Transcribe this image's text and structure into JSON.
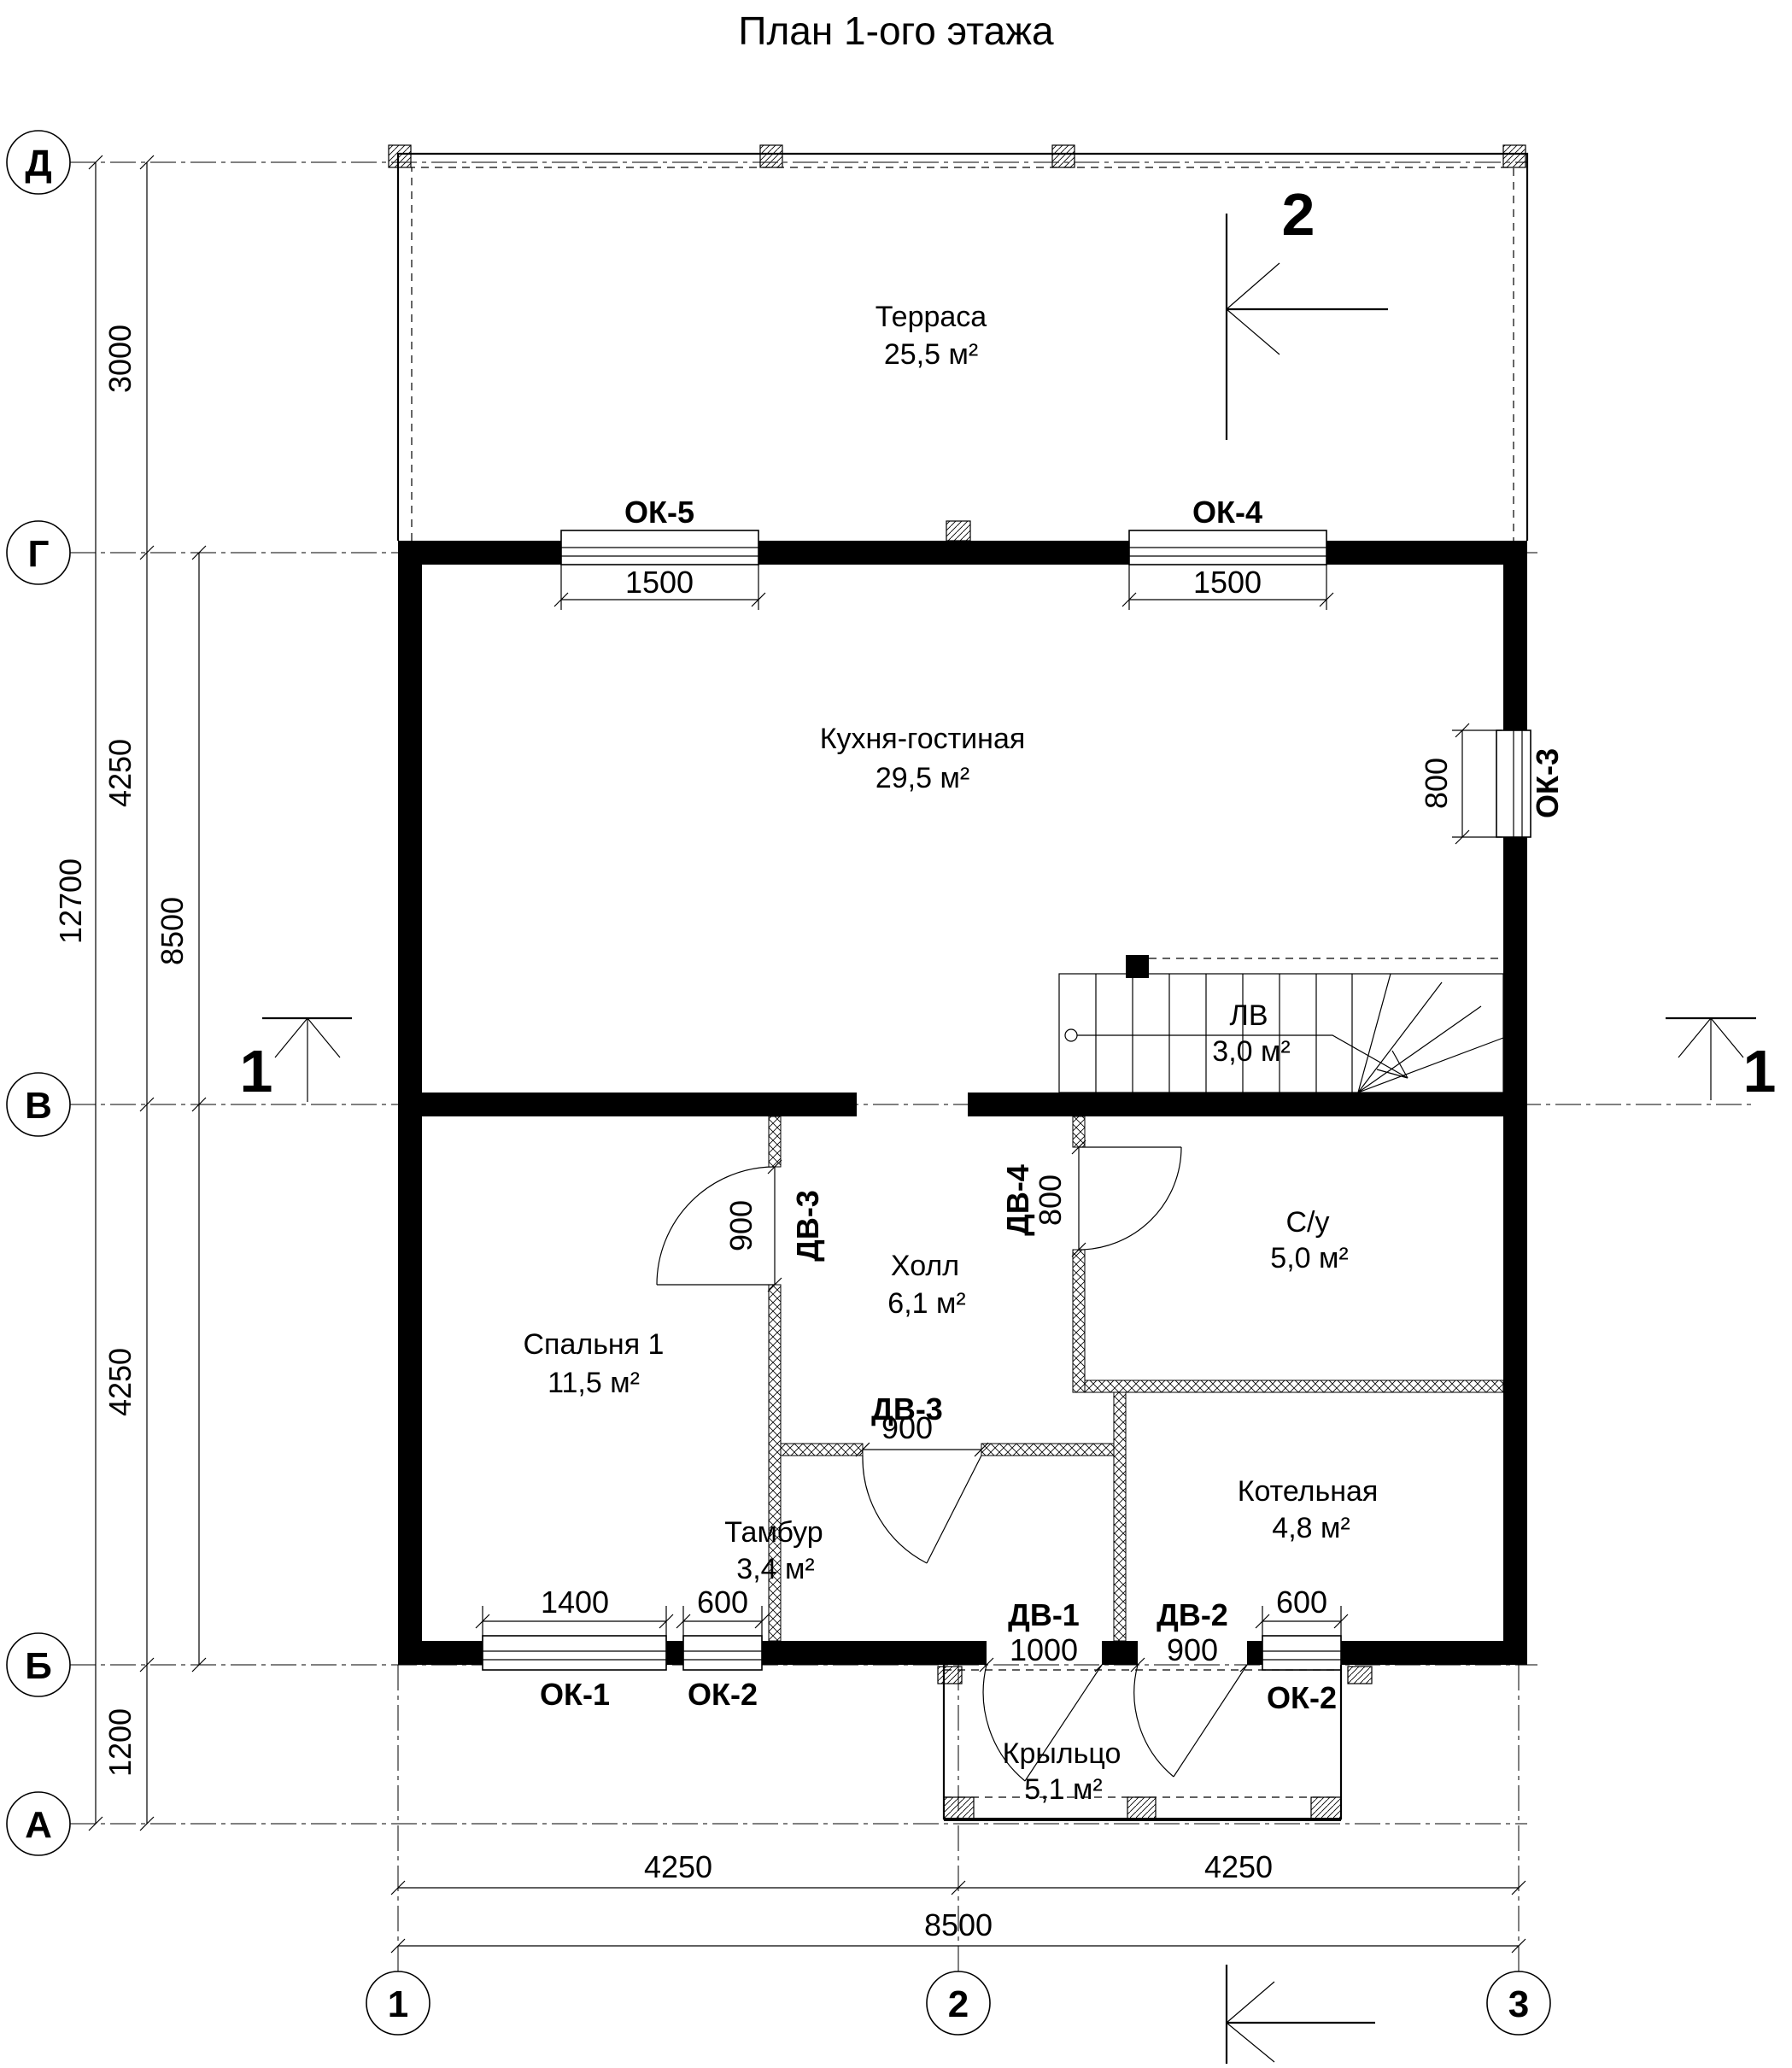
{
  "title": "План 1-ого этажа",
  "axis_rows": {
    "d": "Д",
    "g": "Г",
    "v": "В",
    "b": "Б",
    "a": "А"
  },
  "axis_cols": {
    "c1": "1",
    "c2": "2",
    "c3": "3"
  },
  "dims_left": {
    "d3000": "3000",
    "d4250_top": "4250",
    "d4250_bottom": "4250",
    "d1200": "1200",
    "d12700": "12700",
    "d8500": "8500"
  },
  "dims_bottom": {
    "left": "4250",
    "right": "4250",
    "total": "8500"
  },
  "rooms": {
    "terrace": {
      "name": "Терраса",
      "area": "25,5 м²"
    },
    "kitchen": {
      "name": "Кухня-гостиная",
      "area": "29,5 м²"
    },
    "stairs": {
      "name": "ЛВ",
      "area": "3,0 м²"
    },
    "bedroom": {
      "name": "Спальня 1",
      "area": "11,5 м²"
    },
    "hall": {
      "name": "Холл",
      "area": "6,1 м²"
    },
    "bathroom": {
      "name": "С/у",
      "area": "5,0 м²"
    },
    "vestibule": {
      "name": "Тамбур",
      "area": "3,4 м²"
    },
    "boiler": {
      "name": "Котельная",
      "area": "4,8 м²"
    },
    "porch": {
      "name": "Крыльцо",
      "area": "5,1 м²"
    }
  },
  "windows": {
    "ok5": {
      "label": "ОК-5",
      "width": "1500"
    },
    "ok4": {
      "label": "ОК-4",
      "width": "1500"
    },
    "ok3": {
      "label": "ОК-3",
      "width": "800"
    },
    "ok1": {
      "label": "ОК-1",
      "width": "1400"
    },
    "ok2_left": {
      "label": "ОК-2",
      "width": "600"
    },
    "ok2_right": {
      "label": "ОК-2",
      "width": "600"
    }
  },
  "doors": {
    "dv1": {
      "label": "ДВ-1",
      "width": "1000"
    },
    "dv2": {
      "label": "ДВ-2",
      "width": "900"
    },
    "dv3_bedroom": {
      "label": "ДВ-3",
      "width": "900"
    },
    "dv3_vestibule": {
      "label": "ДВ-3",
      "width": "900"
    },
    "dv4": {
      "label": "ДВ-4",
      "width": "800"
    }
  },
  "sections": {
    "s1": "1",
    "s2": "2"
  },
  "colors": {
    "wall": "#000000",
    "line": "#1a1a1a",
    "background": "#ffffff"
  }
}
